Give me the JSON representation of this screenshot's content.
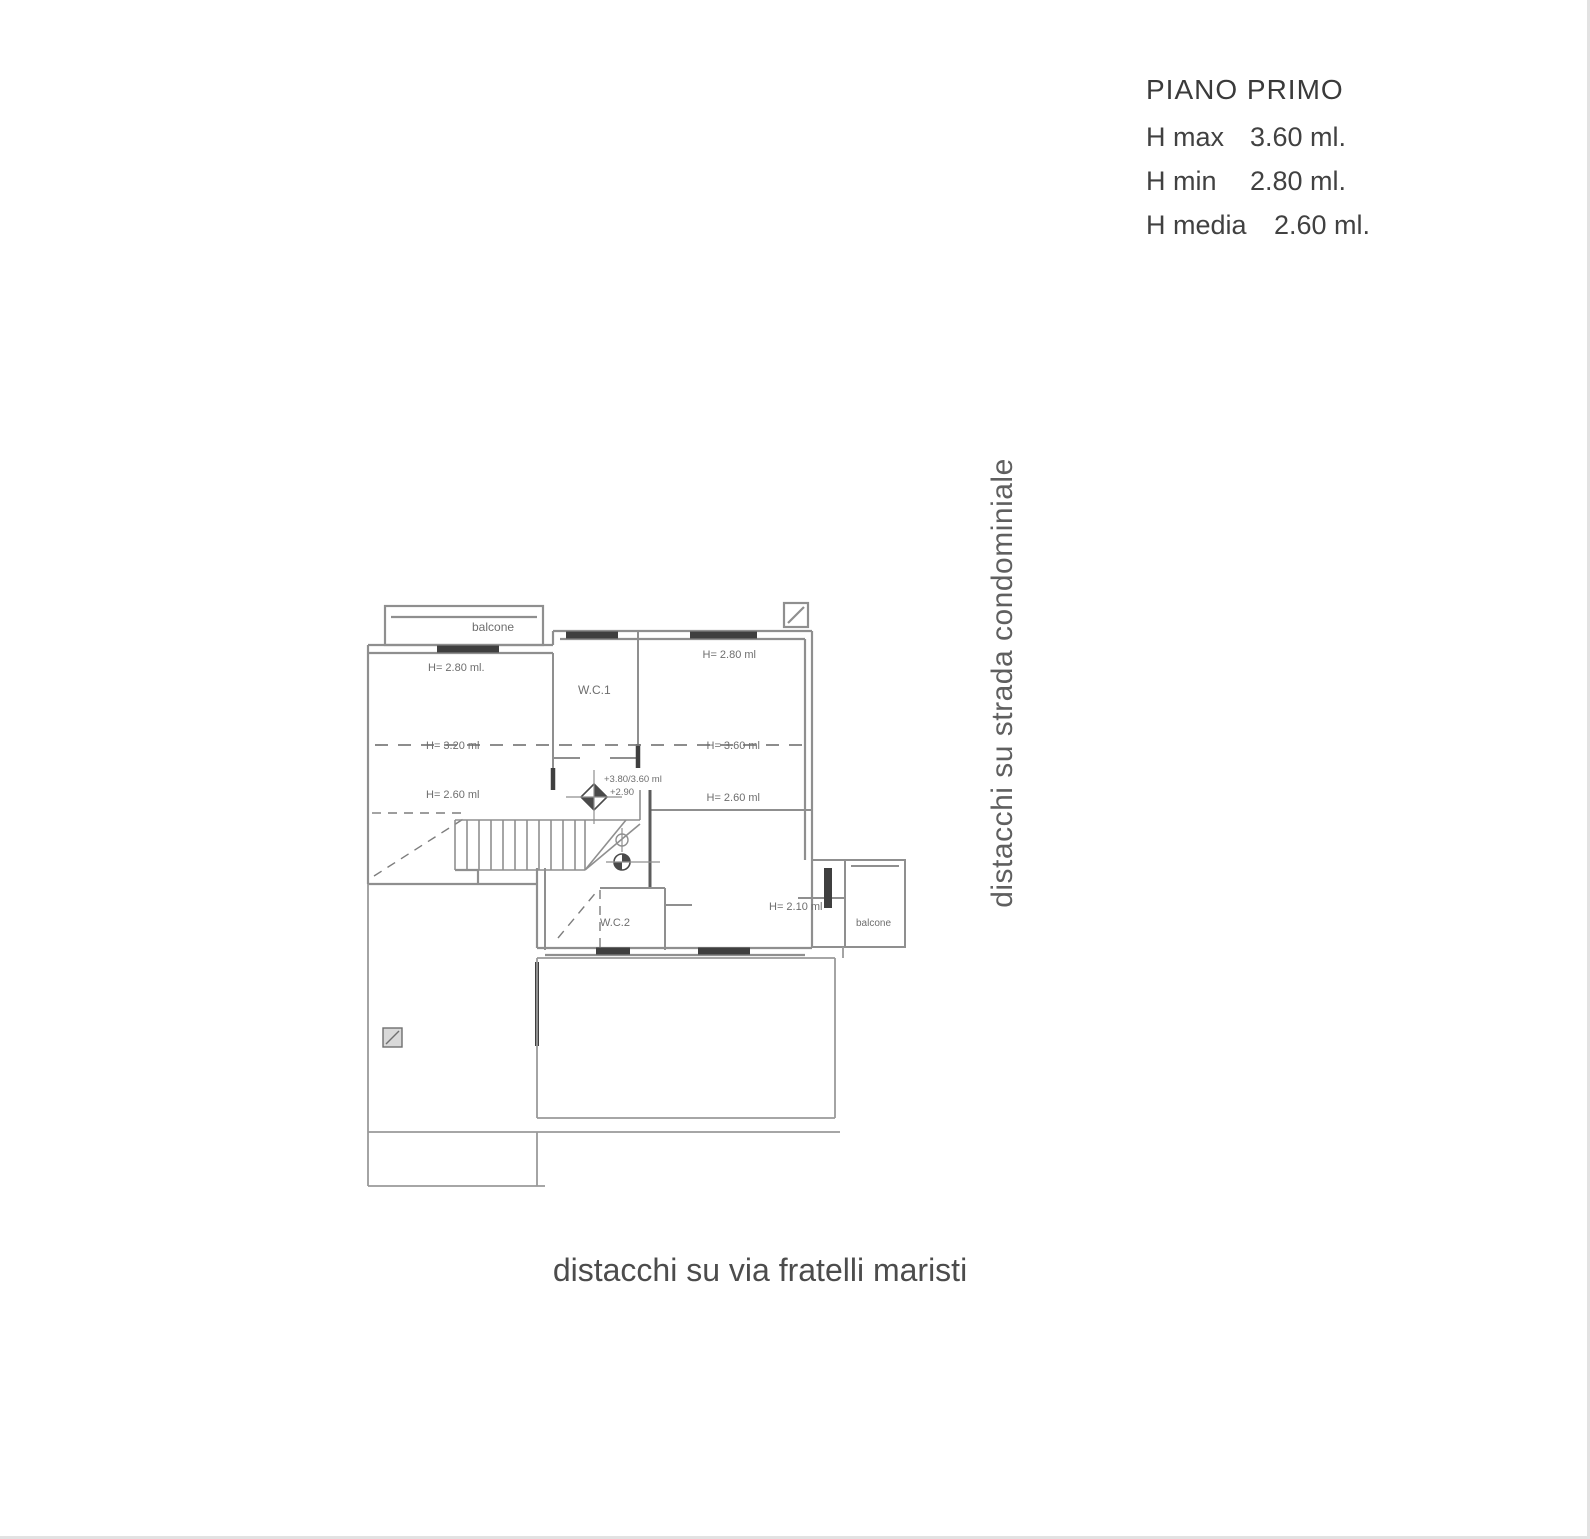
{
  "colors": {
    "background": "#ffffff",
    "plan_line": "#8f8f8f",
    "plan_wall_dark": "#3f3f3f",
    "plan_text": "#6e6e6e",
    "legend_text": "#3f3f3f",
    "annotation_text": "#5f5f5f"
  },
  "legend": {
    "title": "PIANO PRIMO",
    "rows": [
      {
        "label": "H max",
        "value": "3.60 ml."
      },
      {
        "label": "H min",
        "value": "2.80 ml."
      },
      {
        "label": "H media",
        "value": "2.60 ml."
      }
    ]
  },
  "annotations": {
    "right_vertical": "distacchi su strada condominiale",
    "bottom": "distacchi su via fratelli maristi"
  },
  "plan": {
    "balcony_top_label": "balcone",
    "balcony_right_label": "balcone",
    "wc1_label": "W.C.1",
    "wc2_label": "W.C.2",
    "height_labels": {
      "left_top": "H= 2.80 ml.",
      "left_mid": "H= 3.20 ml",
      "left_low": "H= 2.60 ml",
      "right_top": "H= 2.80 ml",
      "right_mid": "H= 3.60 ml",
      "right_low": "H= 2.60 ml",
      "balcony_door": "H= 2.10 ml"
    },
    "level_labels": {
      "line1": "+3.80/3.60 ml",
      "line2": "+2.90"
    }
  }
}
